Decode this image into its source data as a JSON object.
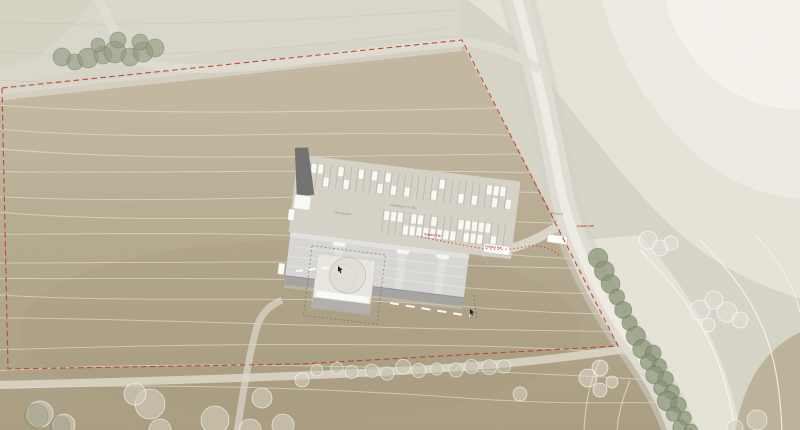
{
  "plan": {
    "kind": "architectural-site-plan"
  },
  "labels": {
    "parking": "Parkplatz 70 Stp.",
    "drill_yard": "Übungshof",
    "entrance": "Einfahrt",
    "fire_access_1": "Zufahrt FW",
    "fire_access_2": "Zufahrt FW",
    "fire_access_3": "Zufahrt FW"
  },
  "colors": {
    "boundary_red": "#c0392b",
    "terrain_tan": "#b7ac93",
    "terrain_light": "#efece4",
    "terrain_lightest": "#f6f4ee",
    "road": "#e2ded5",
    "building_roof": "#d9d8d4",
    "building_shadow": "#a6a5a1",
    "building_dark": "#727270",
    "courtyard": "#eae8e2",
    "tree_green": "#8f987e",
    "tree_gray_green": "#99a08a",
    "tree_pale": "#d9d4c4",
    "marking_white": "#ffffff",
    "label_gray": "#8d877a"
  }
}
